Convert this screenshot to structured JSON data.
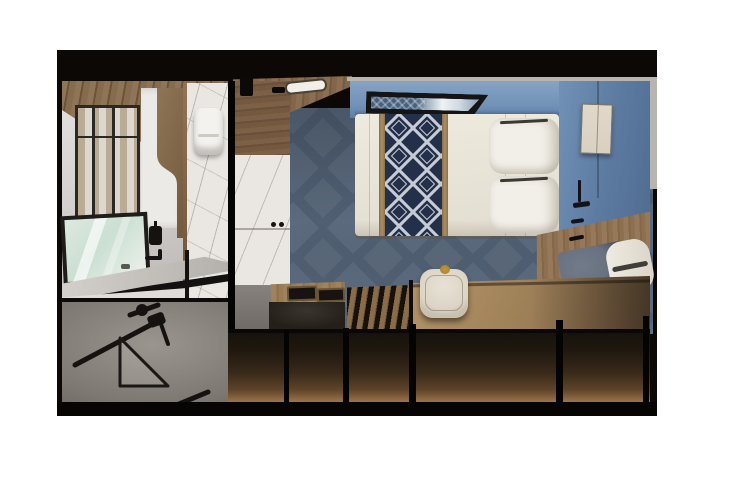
{
  "image": {
    "type": "3d-interior-cutaway-render",
    "subject": "Accessible cruise-ship stateroom seen from above-front: bathroom at left, wardrobe column in middle, bedroom with single bed at right",
    "text_content": "none"
  },
  "objects": {
    "bathroom": [
      "wood-plank-ceiling",
      "glass-partition",
      "curved-wood-wall-accent",
      "marble-wall",
      "toilet",
      "framed-mirror",
      "vanity-counter",
      "soap-dispenser",
      "faucet",
      "shower-floor",
      "fold-down-grab-bar",
      "corner-shower-shelf",
      "short-grab-bar"
    ],
    "closet": [
      "wood-upper-cabinet",
      "vent-panel",
      "marble-wardrobe-doors",
      "door-knobs"
    ],
    "bedroom": [
      "ceiling-light",
      "blue-back-wall",
      "blue-right-wall",
      "picture-window",
      "beige-wall-panel",
      "wall-handles",
      "bed-duvet",
      "diamond-pattern-runner",
      "runner-trim",
      "pillow-top",
      "pillow-bottom",
      "blue-textured-carpet",
      "bench-backrest",
      "bench-cushion",
      "bolster-pillow",
      "drawer-tops",
      "drawer-handles",
      "glossy-counter",
      "slatted-rack",
      "wood-desk",
      "armchair",
      "gold-knob"
    ],
    "structure": [
      "top-hull-band",
      "cut-wall-dividers",
      "front-cabinet-faces",
      "under-cabinet-glow",
      "grey-cut-edges"
    ]
  },
  "palette": {
    "band_black": "#0b0806",
    "divider": "#060402",
    "wood_a": "#8f7557",
    "wood_b": "#6d5238",
    "bath_wall_dark": "#b7b3b0",
    "partition_frame": "#2b2723",
    "marble": "#eae7e3",
    "toilet_white": "#f4f2ef",
    "mirror_frame": "#1f1d1a",
    "mirror_glass": "#cbdfd2",
    "counter_edge": "#121110",
    "fixture": "#15120f",
    "carpet_base": "#5b6a7d",
    "carpet_dark": "#47566a",
    "carpet_light": "#72808f",
    "wall_blue": "#7191b6",
    "wall_blue_dark": "#4f6b90",
    "window_frame": "#141316",
    "duvet": "#edeade",
    "runner_navy": "#24304a",
    "runner_line": "#c9cfd8",
    "runner_trim": "#a98e66",
    "pillow": "#f2efe8",
    "beige_panel": "#d9d0c0",
    "cushion": "#68717f",
    "bolster": "#efece3",
    "glossy": "#242019",
    "desk_wood": "#a08259",
    "chair_cream": "#e7e1d5",
    "chair_gold": "#c2973d",
    "front_glow": "#8a6642",
    "grey_cut": "#b8b5b0"
  }
}
